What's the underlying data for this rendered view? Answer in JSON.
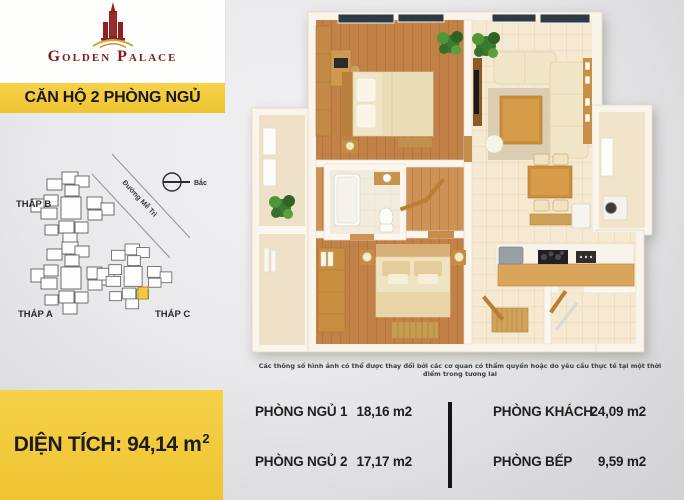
{
  "brand": {
    "name": "Golden Palace"
  },
  "banner": {
    "label": "CĂN HỘ 2 PHÒNG NGỦ"
  },
  "site_map": {
    "tower_b_label": "THÁP B",
    "tower_a_label": "THÁP A",
    "tower_c_label": "THÁP C",
    "road_label": "Đường Mễ Trì",
    "north_label": "Bắc",
    "highlight_color": "#f3ca3b"
  },
  "area_box": {
    "label": "DIỆN TÍCH: 94,14 m",
    "superscript": "2"
  },
  "disclaimer": "Các thông số hình ảnh có thể được thay đổi bởi các cơ quan có thẩm quyền hoặc do yêu cầu thực tế tại một thời điểm trong tương lai",
  "rooms": {
    "left_column": [
      {
        "name": "PHÒNG NGỦ 1",
        "area": "18,16 m2"
      },
      {
        "name": "PHÒNG NGỦ 2",
        "area": "17,17 m2"
      }
    ],
    "right_column": [
      {
        "name": "PHÒNG KHÁCH",
        "area": "24,09 m2"
      },
      {
        "name": "PHÒNG BẾP",
        "area": "9,59 m2"
      }
    ]
  },
  "colors": {
    "accent_yellow": "#f3ca3b",
    "brand_red": "#8e2020"
  }
}
